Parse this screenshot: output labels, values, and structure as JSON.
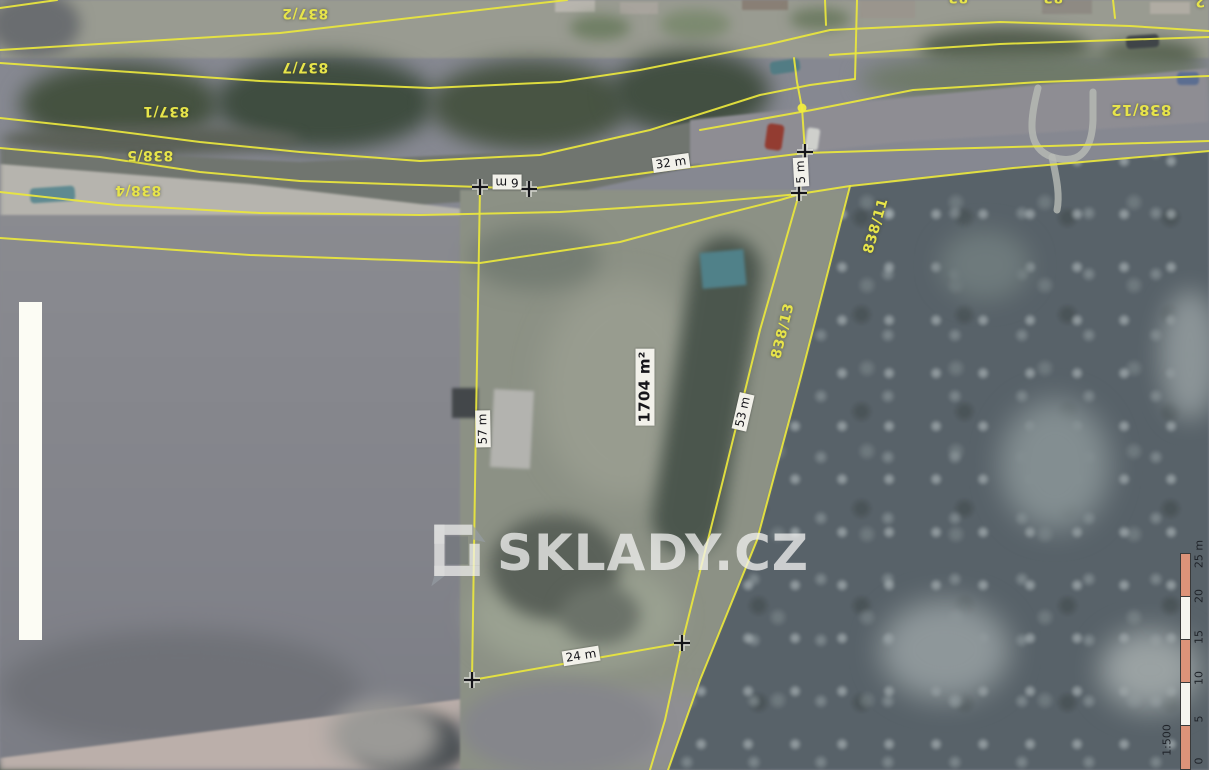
{
  "map": {
    "type": "cadastral aerial map",
    "line_color": "#e9e63d",
    "label_color": "#e7e44a",
    "scalebar_colors": [
      "#dd9379",
      "#f6f5ef"
    ]
  },
  "parcels": [
    {
      "id": "837/2"
    },
    {
      "id": "837/7"
    },
    {
      "id": "837/1"
    },
    {
      "id": "838/5"
    },
    {
      "id": "838/4"
    },
    {
      "id": "838/12"
    },
    {
      "id": "838/11"
    },
    {
      "id": "838/13"
    },
    {
      "id": "83"
    },
    {
      "id": "83"
    },
    {
      "id": "2"
    }
  ],
  "dimensions": [
    {
      "text": "32 m"
    },
    {
      "text": "6 m"
    },
    {
      "text": "5 m"
    },
    {
      "text": "57 m"
    },
    {
      "text": "53 m"
    },
    {
      "text": "24 m"
    }
  ],
  "area_label": {
    "text": "1704 m²"
  },
  "watermark": {
    "text": "SKLADY.CZ"
  },
  "scalebar": {
    "ticks": [
      "25 m",
      "20",
      "15",
      "10",
      "5",
      "0"
    ],
    "ratio": "1:500"
  }
}
